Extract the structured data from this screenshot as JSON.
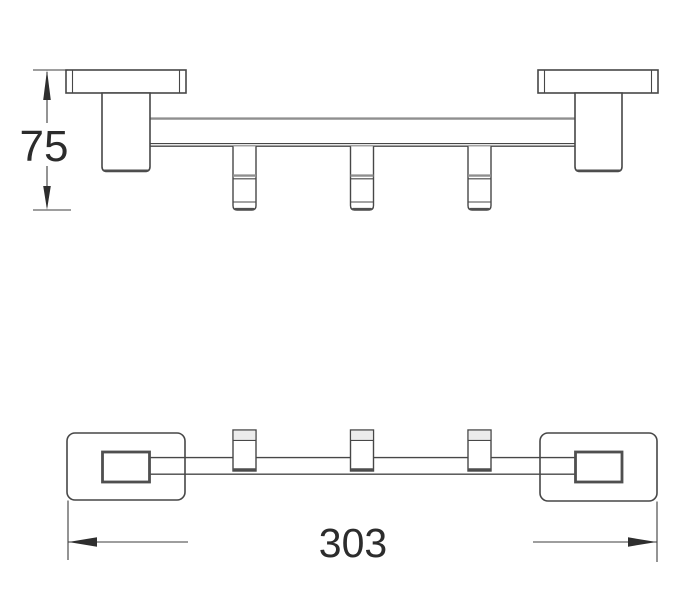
{
  "diagram": {
    "type": "technical-drawing",
    "subject": "wall-mounted rail with three hooks, two square wall plates",
    "views": [
      {
        "name": "front-elevation"
      },
      {
        "name": "top-plan"
      }
    ],
    "dimensions": [
      {
        "id": "height",
        "value": "75",
        "orientation": "vertical",
        "units": ""
      },
      {
        "id": "length",
        "value": "303",
        "orientation": "horizontal",
        "units": ""
      }
    ],
    "colors": {
      "background": "#ffffff",
      "line": "#474747",
      "gray_line": "#8f8f8f",
      "dimension_text": "#2c2c2c",
      "arrow_fill": "#2e2e2e"
    }
  }
}
